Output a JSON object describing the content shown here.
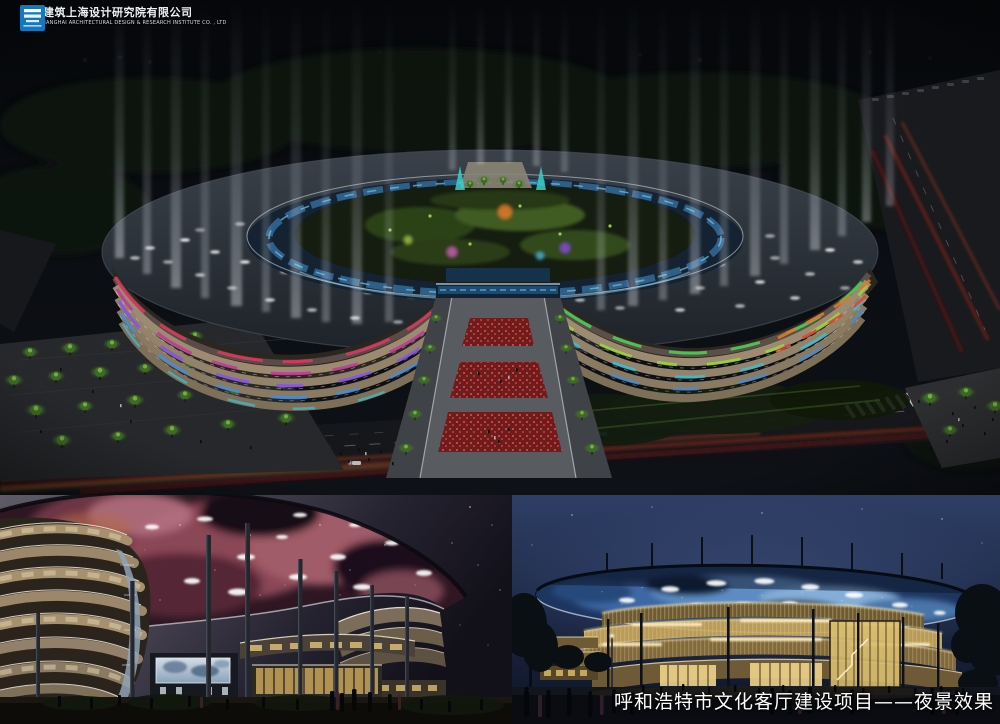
{
  "branding": {
    "company_name_cn": "中国建筑上海设计研究院有限公司",
    "company_name_en": "CHINA SHANGHAI ARCHITECTURAL DESIGN & RESEARCH INSTITUTE CO. , LTD",
    "logo_color": "#1478be"
  },
  "caption": {
    "text": "呼和浩特市文化客厅建设项目——夜景效果",
    "color": "#ffffff"
  },
  "palette": {
    "night_sky": "#0a0d12",
    "roof_slate": "#2c3238",
    "facade_tan": "#9c8b70",
    "accent_red": "#d8385e",
    "accent_magenta": "#c03a9a",
    "accent_purple": "#8a52e8",
    "accent_blue": "#3e8ee0",
    "accent_cyan": "#38c0d8",
    "accent_green": "#49c952",
    "accent_lime": "#9ad838",
    "accent_orange": "#e07828",
    "nebula_pink": "#8a4656",
    "canopy_star_blue": "#5d8cc4",
    "facade_gold": "#caa75c",
    "tree_glow_green": "#86b83f",
    "plaza_red": "#cf4040"
  }
}
